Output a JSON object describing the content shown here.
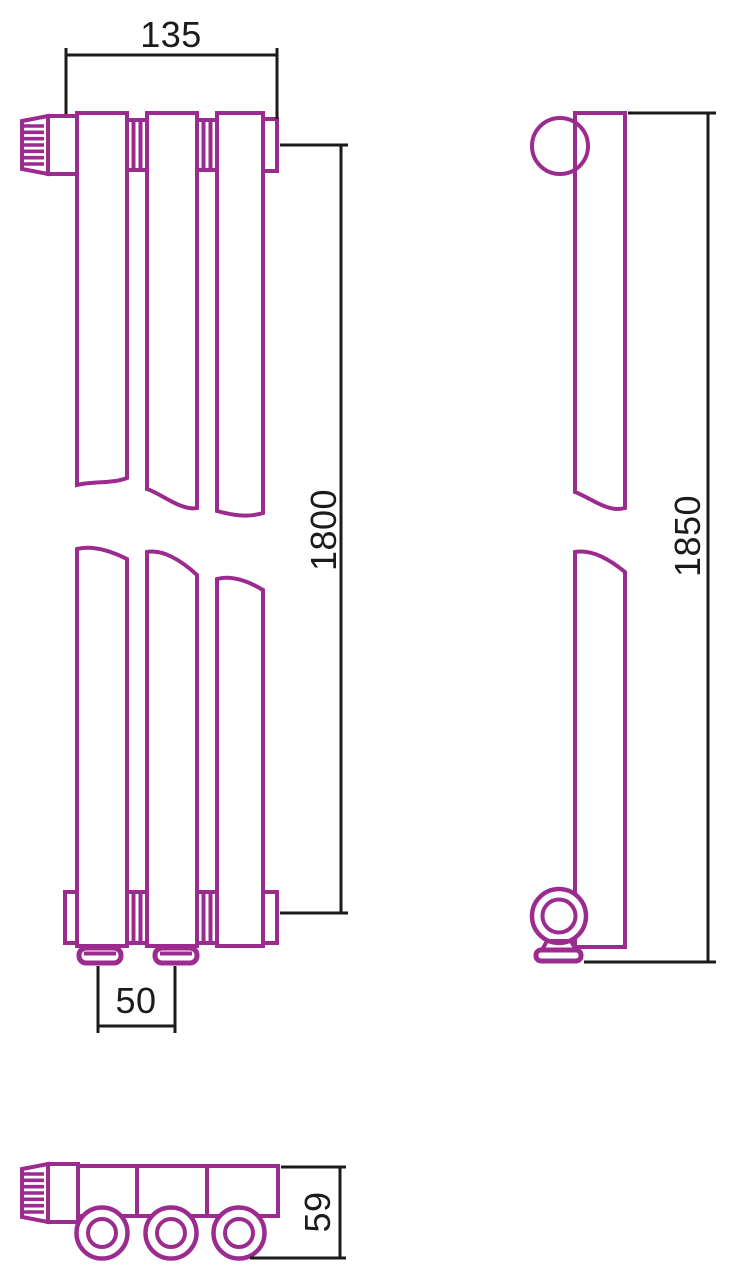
{
  "drawing": {
    "type": "radiator-technical-dimension-drawing",
    "views": {
      "front": "front view with three vertical tubes, valve knob, break lines",
      "side": "side profile with round knob top and wall-mount foot",
      "top": "top view with collector bar and three tube rings"
    }
  },
  "dimensions": {
    "front_width": "135",
    "front_height": "1800",
    "bottom_pitch": "50",
    "side_height": "1850",
    "depth": "59"
  },
  "colors": {
    "outline": "#9C2B8F",
    "dimension_lines": "#1b1b1b",
    "background": "#ffffff"
  }
}
